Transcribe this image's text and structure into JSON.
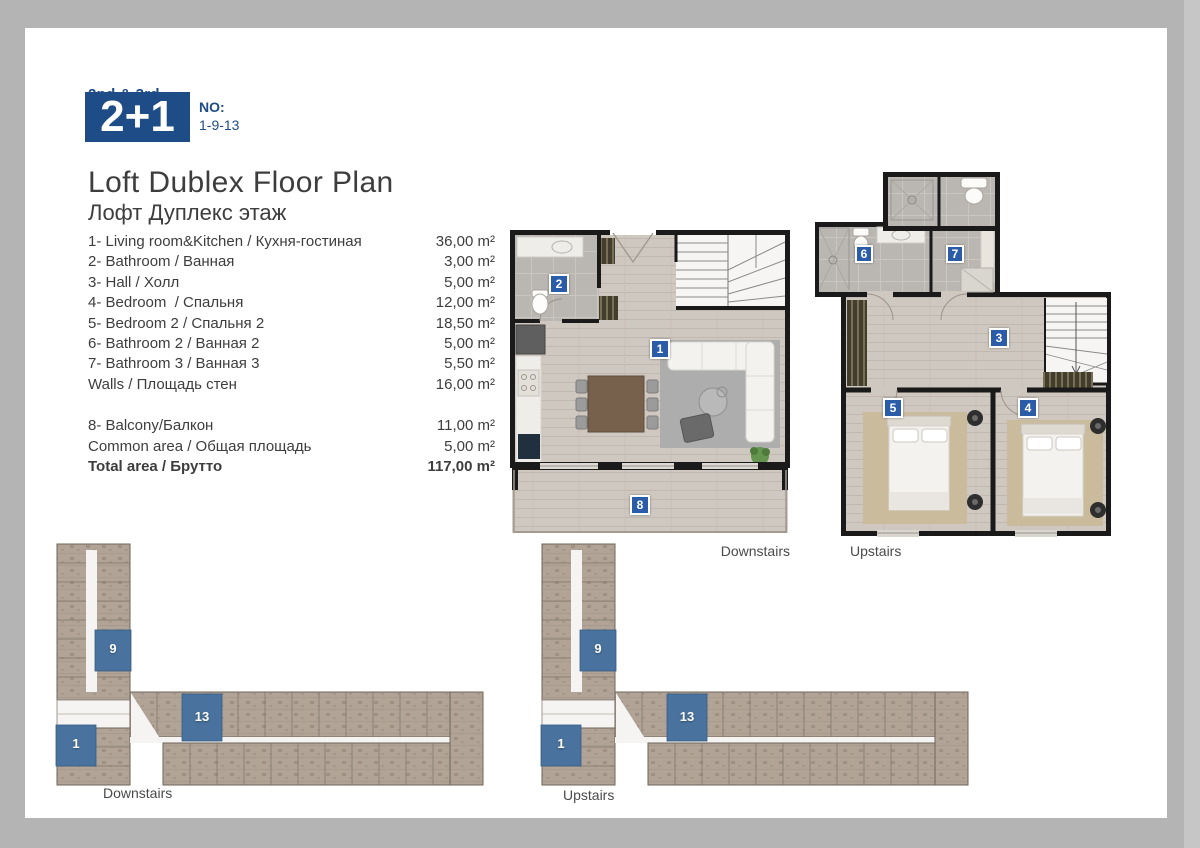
{
  "header": {
    "floors": "2nd & 3rd",
    "unit_type": "2+1",
    "no_label": "NO:",
    "no_value": "1-9-13"
  },
  "title": {
    "en": "Loft Dublex Floor Plan",
    "ru": "Лофт Дуплекс этаж"
  },
  "room_list": {
    "rows": [
      {
        "label": "1- Living room&Kitchen / Кухня-гостиная",
        "area": "36,00 m²"
      },
      {
        "label": "2- Bathroom / Ванная",
        "area": "3,00 m²"
      },
      {
        "label": "3- Hall / Холл",
        "area": "5,00 m²"
      },
      {
        "label": "4- Bedroom  / Спальня",
        "area": "12,00 m²"
      },
      {
        "label": "5- Bedroom 2 / Спальня 2",
        "area": "18,50 m²"
      },
      {
        "label": "6- Bathroom 2 / Ванная 2",
        "area": "5,00 m²"
      },
      {
        "label": "7- Bathroom 3 / Ванная 3",
        "area": "5,50 m²"
      },
      {
        "label": "Walls / Площадь стен",
        "area": "16,00 m²"
      }
    ],
    "extra_rows": [
      {
        "label": "8- Balcony/Балкон",
        "area": "11,00 m²"
      },
      {
        "label": "Common area / Общая площадь",
        "area": "5,00 m²"
      }
    ],
    "total": {
      "label": "Total area / Брутто",
      "area": "117,00 m²"
    }
  },
  "unit_plans": {
    "downstairs_label": "Downstairs",
    "upstairs_label": "Upstairs",
    "badges": {
      "living": "1",
      "bathroom": "2",
      "hall": "3",
      "bedroom": "4",
      "bedroom2": "5",
      "bathroom2": "6",
      "bathroom3": "7",
      "balcony": "8"
    }
  },
  "site_plans": {
    "downstairs": {
      "label": "Downstairs",
      "units": [
        "9",
        "13",
        "1"
      ]
    },
    "upstairs": {
      "label": "Upstairs",
      "units": [
        "9",
        "13",
        "1"
      ]
    }
  },
  "colors": {
    "navy": "#1e4c86",
    "badge_blue": "#2a5ca8",
    "highlight_blue": "#49739e",
    "wall": "#1a1a1a",
    "wood_floor": "#cfc8c0",
    "tile_floor": "#bab6b2"
  }
}
